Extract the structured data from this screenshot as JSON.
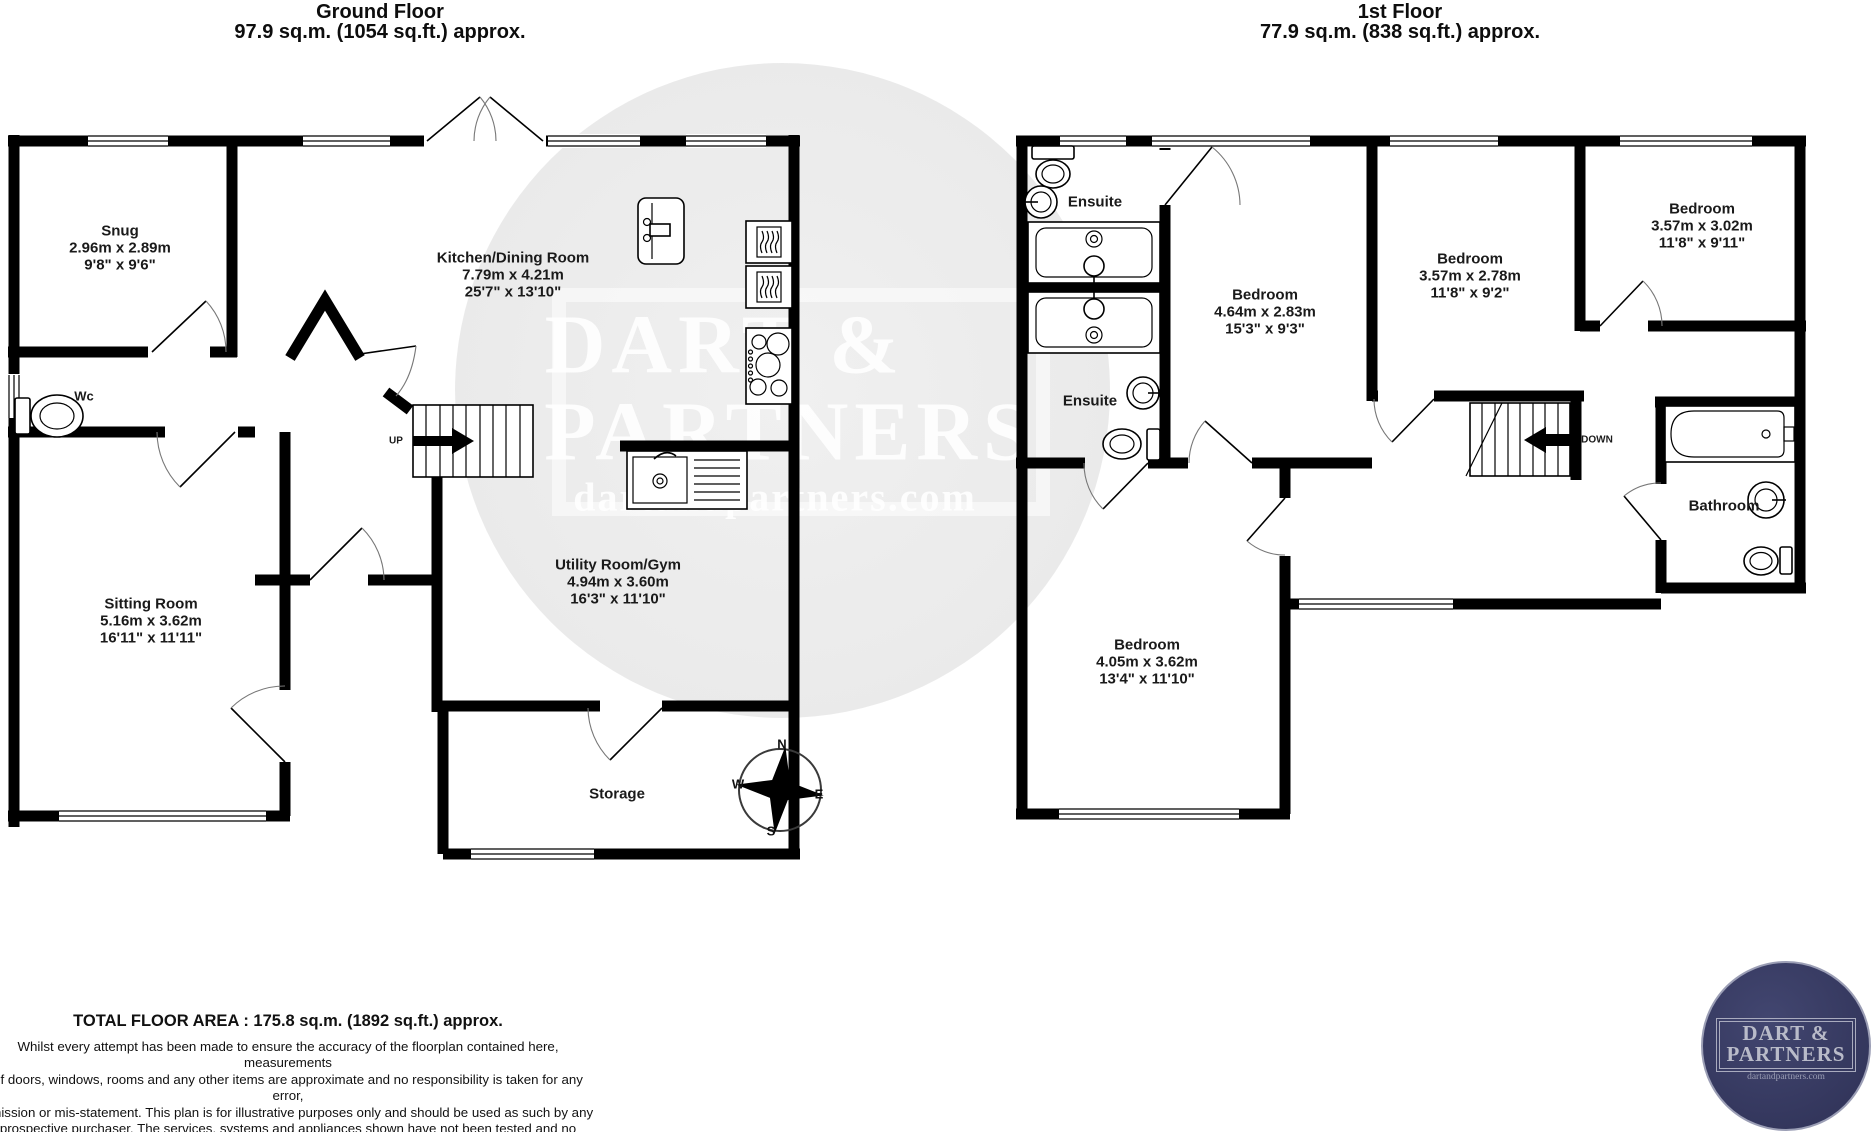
{
  "floors": {
    "ground": {
      "title": "Ground Floor",
      "area": "97.9 sq.m. (1054 sq.ft.) approx.",
      "stairs_label": "UP",
      "rooms": {
        "snug": {
          "name": "Snug",
          "metric": "2.96m x 2.89m",
          "imperial": "9'8\" x 9'6\""
        },
        "kitchen": {
          "name": "Kitchen/Dining Room",
          "metric": "7.79m x 4.21m",
          "imperial": "25'7\" x 13'10\""
        },
        "wc": {
          "name": "Wc"
        },
        "sitting": {
          "name": "Sitting Room",
          "metric": "5.16m x 3.62m",
          "imperial": "16'11\" x 11'11\""
        },
        "utility": {
          "name": "Utility Room/Gym",
          "metric": "4.94m x 3.60m",
          "imperial": "16'3\" x 11'10\""
        },
        "storage": {
          "name": "Storage"
        }
      }
    },
    "first": {
      "title": "1st Floor",
      "area": "77.9 sq.m. (838 sq.ft.) approx.",
      "stairs_label": "DOWN",
      "rooms": {
        "ensuite_top": {
          "name": "Ensuite"
        },
        "ensuite_mid": {
          "name": "Ensuite"
        },
        "bedroom1": {
          "name": "Bedroom",
          "metric": "4.64m x 2.83m",
          "imperial": "15'3\" x 9'3\""
        },
        "bedroom2": {
          "name": "Bedroom",
          "metric": "3.57m x 2.78m",
          "imperial": "11'8\" x 9'2\""
        },
        "bedroom3": {
          "name": "Bedroom",
          "metric": "3.57m x 3.02m",
          "imperial": "11'8\" x 9'11\""
        },
        "bathroom": {
          "name": "Bathroom"
        },
        "bedroom4": {
          "name": "Bedroom",
          "metric": "4.05m x 3.62m",
          "imperial": "13'4\" x 11'10\""
        }
      }
    }
  },
  "compass": {
    "n": "N",
    "e": "E",
    "s": "S",
    "w": "W"
  },
  "watermark": {
    "line1": "DART &",
    "line2": "PARTNERS",
    "url": "dartandpartners.com"
  },
  "logo": {
    "line1": "DART &",
    "line2": "PARTNERS",
    "url": "dartandpartners.com",
    "bg_color": "#373a64",
    "fg_color": "#b9bbc9"
  },
  "footer": {
    "total": "TOTAL FLOOR AREA : 175.8 sq.m. (1892 sq.ft.) approx.",
    "disclaimer_lines": [
      "Whilst every attempt has been made to ensure the accuracy of the floorplan contained here, measurements",
      "of doors, windows, rooms and any other items are approximate and no responsibility is taken for any error,",
      "omission or mis-statement. This plan is for illustrative purposes only and should be used as such by any",
      "prospective purchaser. The services, systems and appliances shown have not been tested and no guarantee",
      "as to their operability or efficiency can be given."
    ],
    "made_with": "Made with Metropix ©2022"
  },
  "colors": {
    "wall": "#000000",
    "watermark_circle": "#ebebeb"
  }
}
